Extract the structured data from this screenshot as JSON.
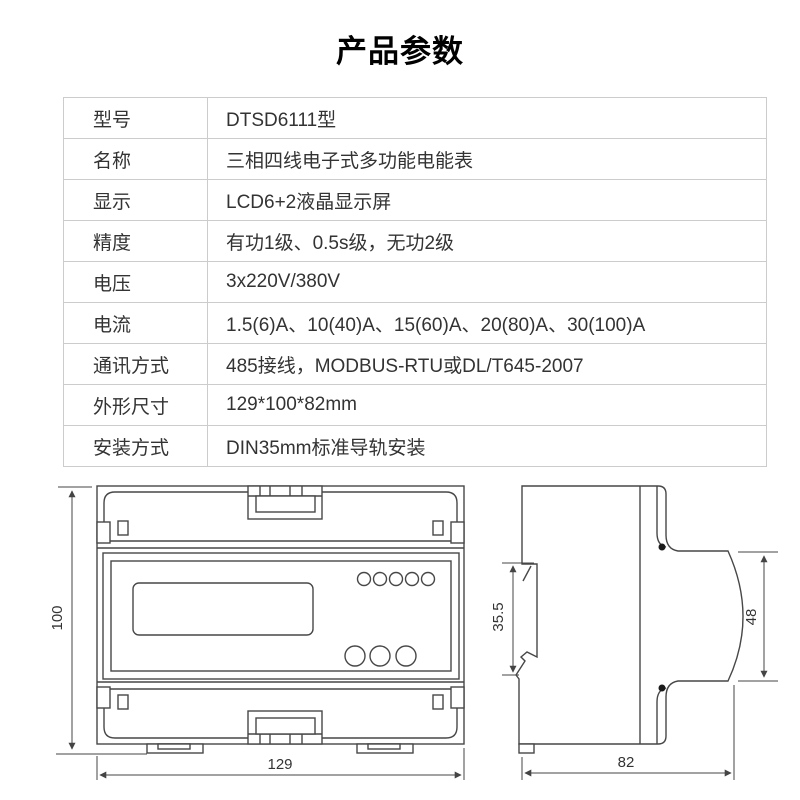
{
  "page": {
    "title": "产品参数"
  },
  "table": {
    "rows": [
      {
        "label": "型号",
        "value": "DTSD6111型"
      },
      {
        "label": "名称",
        "value": "三相四线电子式多功能电能表"
      },
      {
        "label": "显示",
        "value": "LCD6+2液晶显示屏"
      },
      {
        "label": "精度",
        "value": "有功1级、0.5s级，无功2级"
      },
      {
        "label": "电压",
        "value": "3x220V/380V"
      },
      {
        "label": "电流",
        "value": "1.5(6)A、10(40)A、15(60)A、20(80)A、30(100)A"
      },
      {
        "label": "通讯方式",
        "value": "485接线，MODBUS-RTU或DL/T645-2007"
      },
      {
        "label": "外形尺寸",
        "value": "129*100*82mm"
      },
      {
        "label": "安装方式",
        "value": "DIN35mm标准导轨安装"
      }
    ]
  },
  "drawing": {
    "front_view": {
      "height_label": "100",
      "width_label": "129"
    },
    "side_view": {
      "rail_label": "35.5",
      "face_label": "48",
      "depth_label": "82"
    }
  },
  "colors": {
    "line": "#474747",
    "dim_line": "#444444",
    "table_border": "#cccccc",
    "text": "#333333"
  }
}
